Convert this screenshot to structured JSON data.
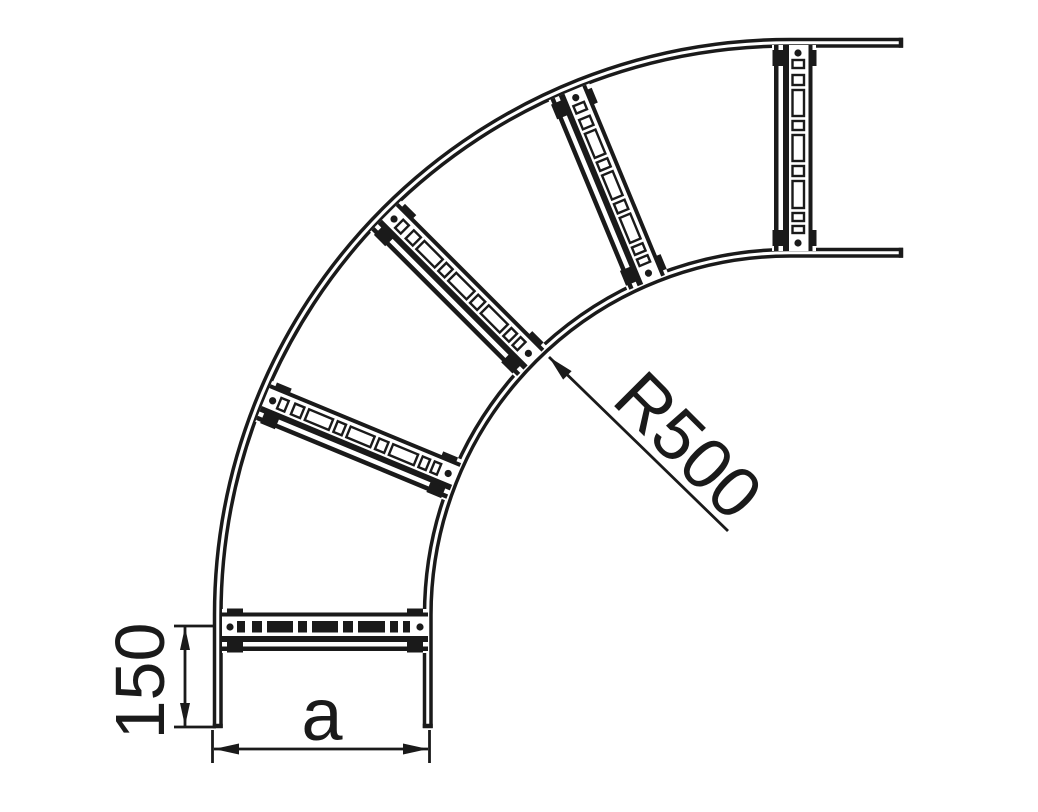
{
  "document": {
    "type": "technical-line-drawing",
    "subject": "Cable ladder 90 degree bend, plan view"
  },
  "labels": {
    "radius": "R500",
    "end_rung_offset": "150",
    "width": "a"
  },
  "drawing": {
    "ink": "#1a1a1a",
    "background": "#ffffff",
    "center": {
      "x": 790,
      "y": 615
    },
    "rail_line_radii": [
      575.5,
      569,
      365.5,
      359
    ],
    "rail_stroke": 3.5,
    "bottom_end_y": 728,
    "right_end_x": 903,
    "mid_radius": 465,
    "rung": {
      "half_length": 103,
      "rivet_x": 95,
      "rivet_r": 3.6,
      "slots": [
        [
          -88,
          8
        ],
        [
          -73,
          10
        ],
        [
          -58,
          26
        ],
        [
          -27,
          9
        ],
        [
          -13,
          26
        ],
        [
          18,
          10
        ],
        [
          33,
          27
        ],
        [
          65,
          8
        ],
        [
          78,
          7
        ]
      ]
    },
    "rungs": [
      {
        "kind": "straight",
        "cx": 325,
        "cy": 627,
        "rot": 0,
        "slot_style": "filled"
      },
      {
        "kind": "arc",
        "angle": 202.5,
        "slot_style": "outline"
      },
      {
        "kind": "arc",
        "angle": 225,
        "slot_style": "outline"
      },
      {
        "kind": "arc",
        "angle": 247.5,
        "slot_style": "outline"
      },
      {
        "kind": "straight",
        "cx": 798,
        "cy": 148,
        "rot": 90,
        "slot_style": "outline"
      }
    ],
    "dim_150": {
      "line_x": 185,
      "from_y": 627,
      "to_y": 726,
      "ext_x1": 174,
      "ext_x2": 216,
      "text_x": 164,
      "text_y": 681
    },
    "dim_a": {
      "line_y": 749,
      "from_x": 214,
      "to_x": 428,
      "ext_y1": 730,
      "ext_y2": 763,
      "text_x": 322,
      "text_y": 740
    },
    "radius_leader": {
      "tip_x": 549,
      "tip_y": 357,
      "end_x": 728,
      "end_y": 531,
      "text_x": 610,
      "text_y": 402,
      "text_angle": 45
    }
  }
}
